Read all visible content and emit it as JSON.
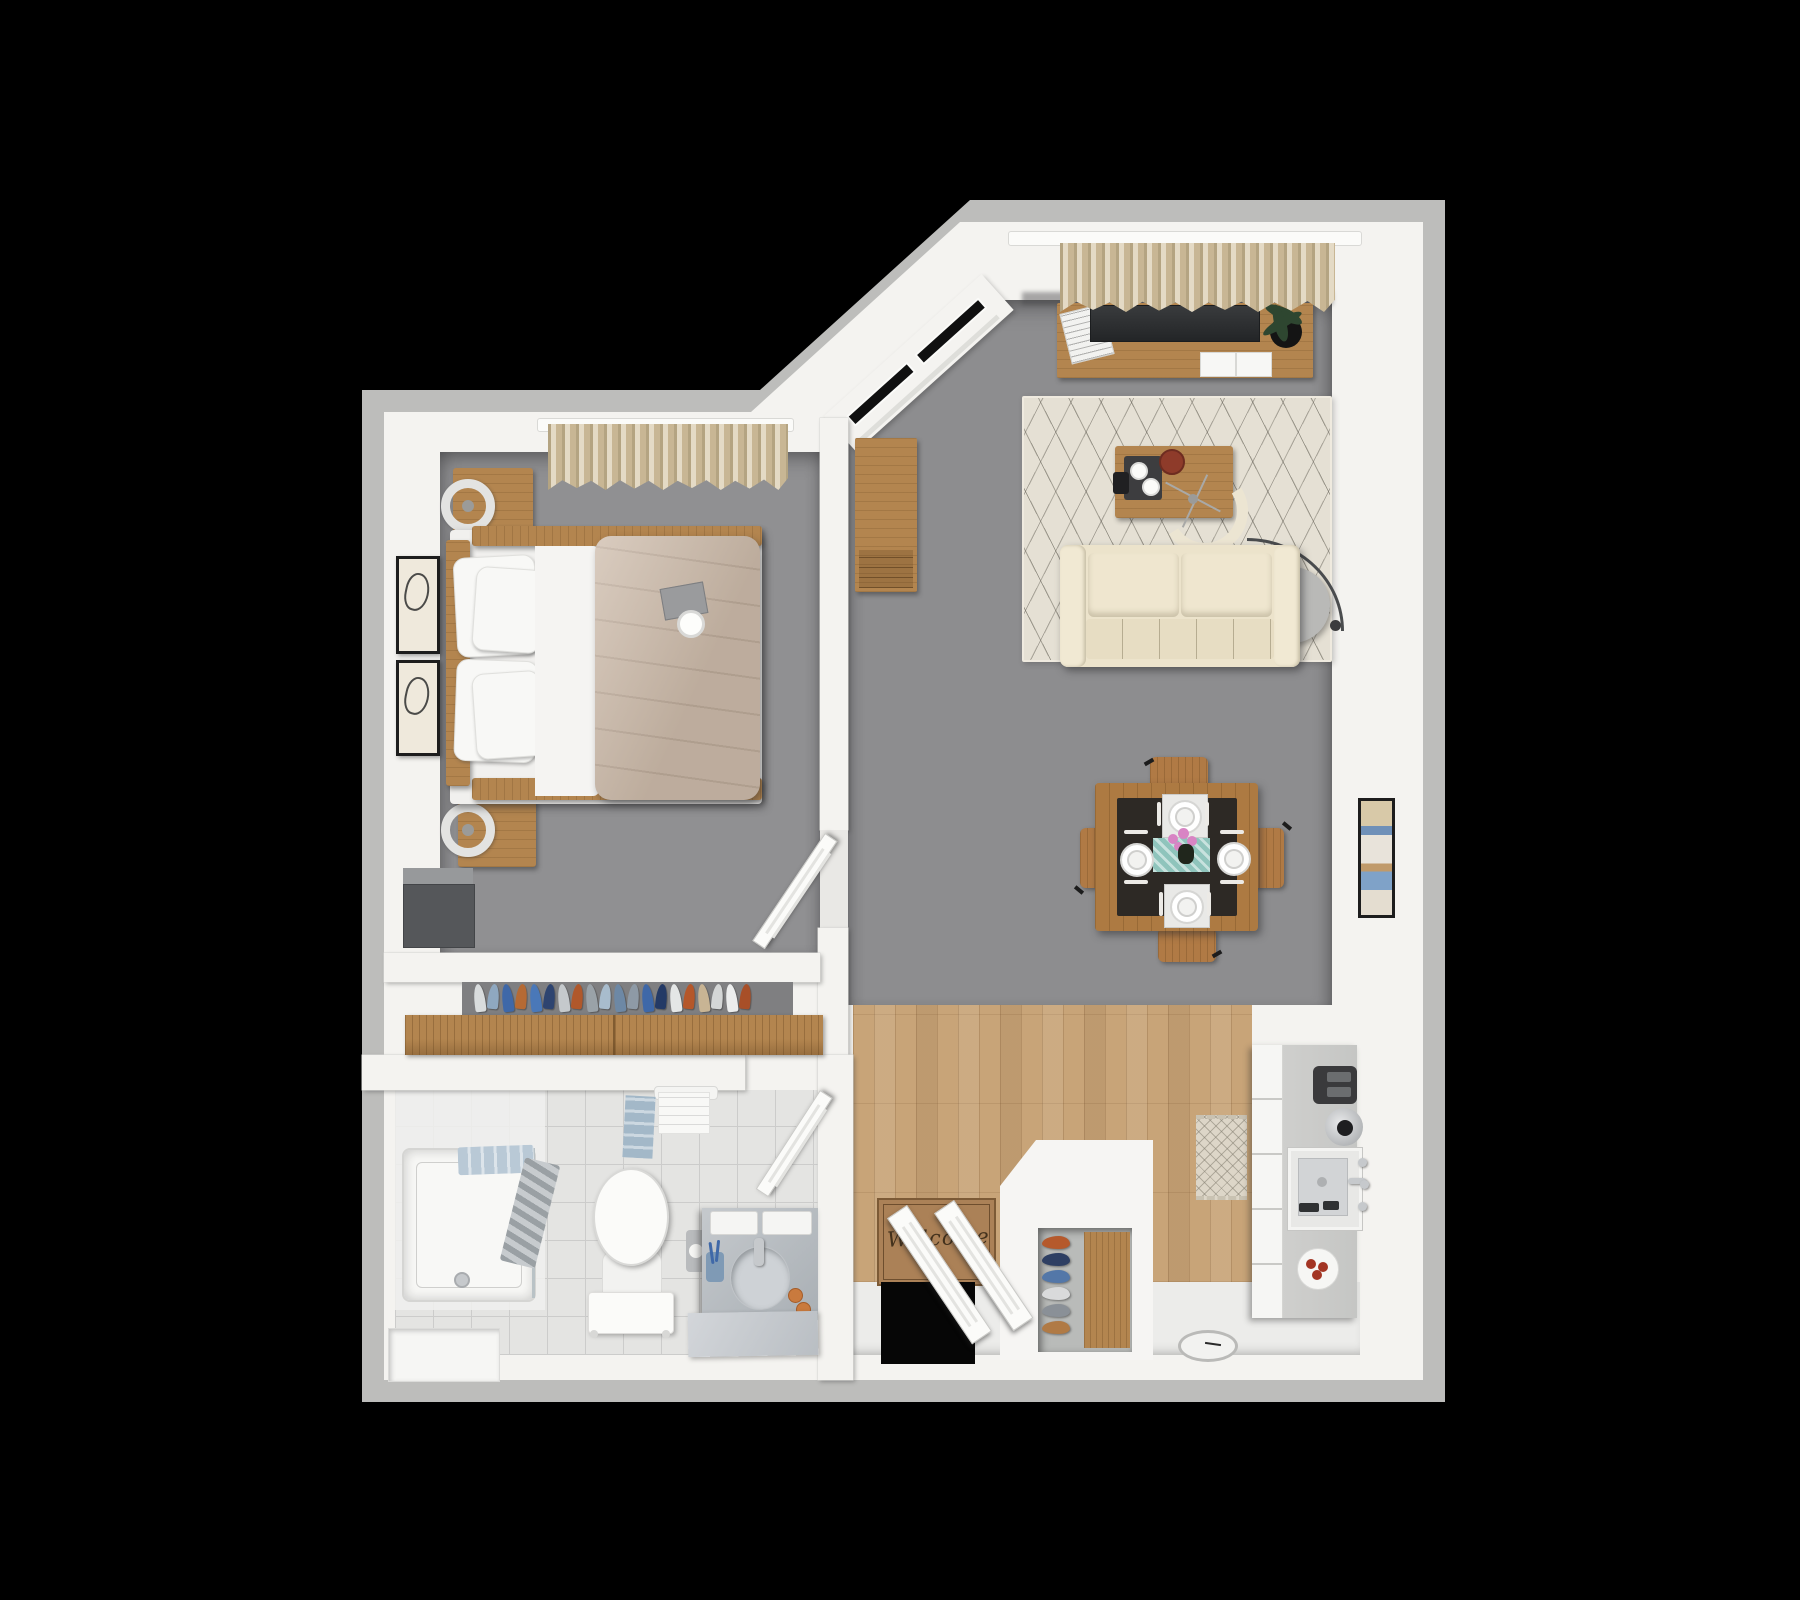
{
  "scene": {
    "description": "3D rendered top-down floor plan of a one-bedroom apartment on a black background",
    "rooms": [
      "bedroom",
      "closet",
      "bathroom",
      "living-room",
      "dining-area",
      "kitchen",
      "entry"
    ]
  },
  "entry": {
    "welcome_mat_text": "Welcome"
  },
  "closet": {
    "clothes_colors": [
      "#d9dcdd",
      "#8fa8c0",
      "#3f68a8",
      "#b56a34",
      "#4a78b8",
      "#2e4470",
      "#c5c9cc",
      "#b0582b",
      "#9aa2a8",
      "#a8bccd",
      "#6d88a5",
      "#8e9aa6",
      "#3f68a8",
      "#243a66",
      "#e4e6e6",
      "#b5572a",
      "#c8b494",
      "#d4d6d6",
      "#eceded",
      "#a84f28"
    ]
  },
  "island": {
    "shoe_colors": [
      "#b5592c",
      "#2e3f63",
      "#5377a8",
      "#d9dadb",
      "#8a9097",
      "#b07a45"
    ]
  },
  "dining": {
    "place_settings": 4,
    "runner_color": "#8fc4bc",
    "flower_color": "#d884c4"
  },
  "palette": {
    "background": "#000000",
    "outer_wall": "#bdbdbb",
    "inner_wall": "#f4f3f0",
    "carpet": "#8e8e90",
    "wood_floor": "#c8a478",
    "tile_floor": "#ececea",
    "furniture_wood": "#b3854f",
    "sofa": "#ece3cb",
    "duvet": "#cdbbaa",
    "curtain": "#d5c6a6",
    "tv": "#2e3032",
    "towel_blue": "#a3b8c8",
    "vanity_marble": "#b9bdc1",
    "welcome_mat": "#ab8157"
  }
}
